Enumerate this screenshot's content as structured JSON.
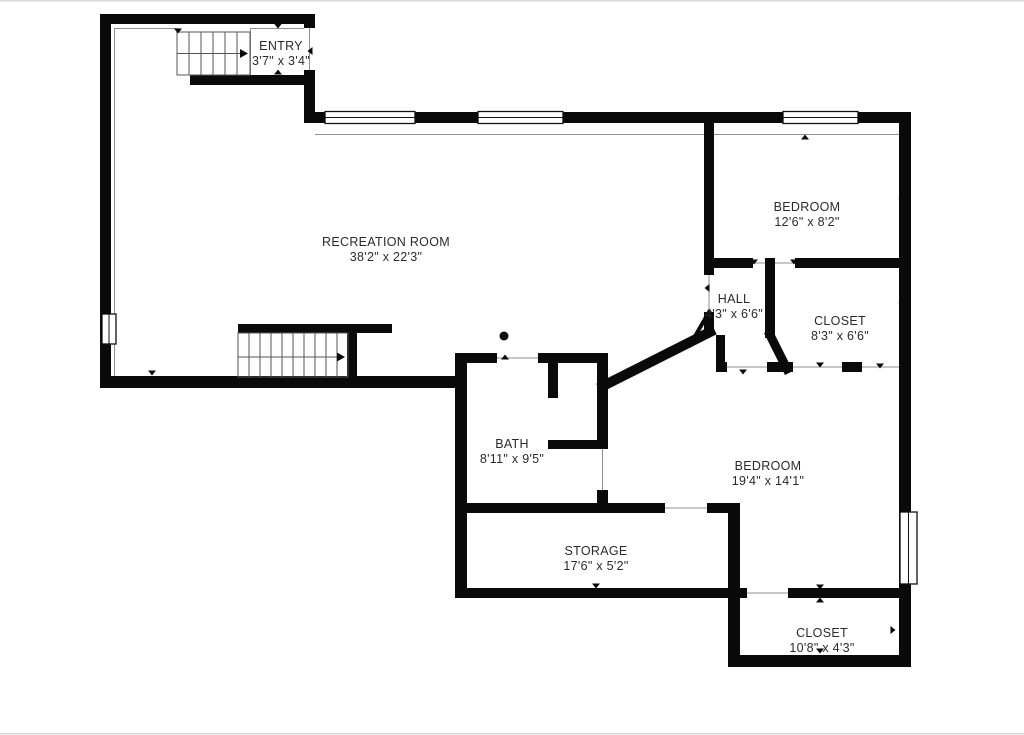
{
  "plan": {
    "rooms": {
      "entry": {
        "label": "ENTRY",
        "dims": "3'7\" x 3'4\""
      },
      "recreation_room": {
        "label": "RECREATION ROOM",
        "dims": "38'2\" x 22'3\""
      },
      "bedroom_upper": {
        "label": "BEDROOM",
        "dims": "12'6\" x 8'2\""
      },
      "hall": {
        "label": "HALL",
        "dims": "4'3\" x 6'6\""
      },
      "closet_upper": {
        "label": "CLOSET",
        "dims": "8'3\" x 6'6\""
      },
      "bath": {
        "label": "BATH",
        "dims": "8'11\" x 9'5\""
      },
      "bedroom_lower": {
        "label": "BEDROOM",
        "dims": "19'4\" x 14'1\""
      },
      "storage": {
        "label": "STORAGE",
        "dims": "17'6\" x 5'2\""
      },
      "closet_lower": {
        "label": "CLOSET",
        "dims": "10'8\" x 4'3\""
      }
    },
    "colors": {
      "wall": "#0a0a0a",
      "label_text": "#2b2b2b",
      "thin_line": "#8f8f8f",
      "background": "#ffffff"
    },
    "icons": {
      "stair_direction_arrow": "▶",
      "opening_tick": "▲",
      "fixture_dot": "●"
    }
  }
}
